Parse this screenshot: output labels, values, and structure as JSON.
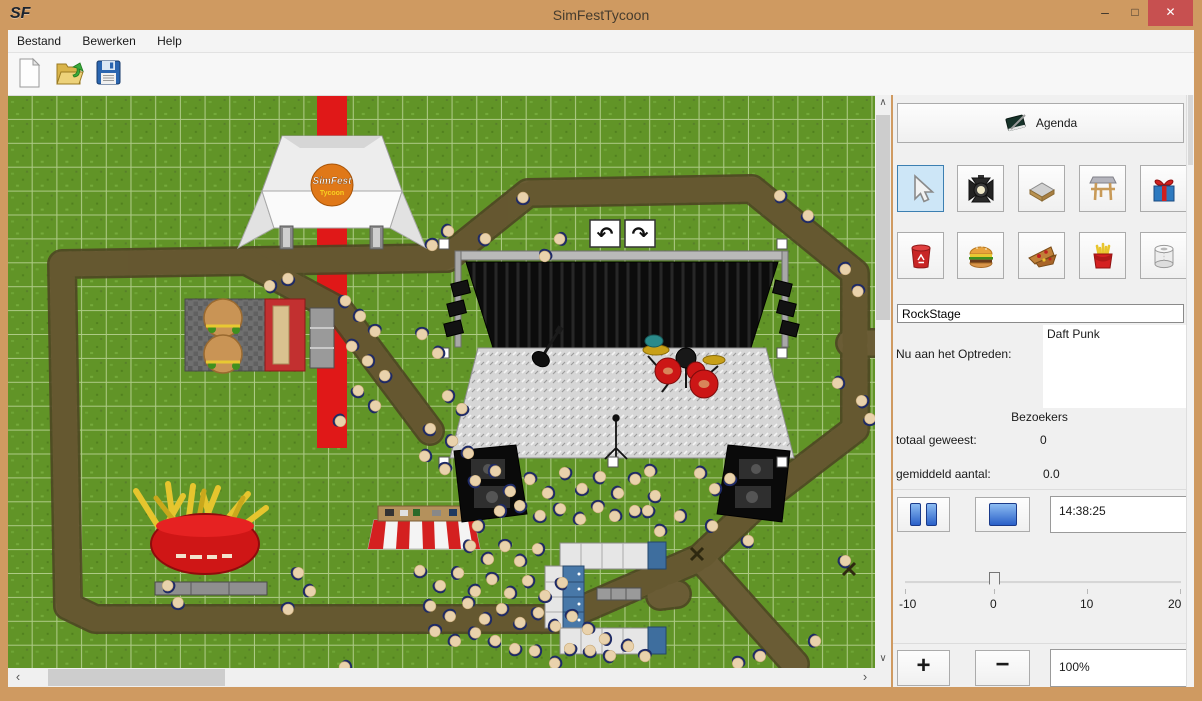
{
  "window": {
    "title": "SimFestTycoon",
    "app_initials": "SF",
    "controls": {
      "minimize": "–",
      "maximize": "□",
      "close": "✕"
    }
  },
  "menu": {
    "items": [
      "Bestand",
      "Bewerken",
      "Help"
    ]
  },
  "toolbar": {
    "buttons": [
      "new-file",
      "open-file",
      "save-file"
    ]
  },
  "icons": {
    "scroll_up": "∧",
    "scroll_down": "∨",
    "scroll_left": "‹",
    "scroll_right": "›",
    "rotate_left": "↶",
    "rotate_right": "↷"
  },
  "colors": {
    "titlebar": "#cf9a61",
    "close_button": "#c75050",
    "selected_tool_bg": "#cde6f7",
    "selected_tool_border": "#3c7fb1",
    "grass": "#619427",
    "path": "#6a5c35",
    "carpet": "#e01818",
    "person_head": "#e9d2ac",
    "person_body": "#1e2a66"
  },
  "panel": {
    "agenda_label": "Agenda",
    "tools": {
      "row1": [
        "cursor",
        "spotlight",
        "path-tile",
        "stage",
        "gift"
      ],
      "row2": [
        "trash-bin",
        "burger",
        "pizza",
        "fries",
        "toilet-paper"
      ],
      "selected": "cursor"
    },
    "stage_name_value": "RockStage",
    "now_performing_label": "Nu aan het Optreden:",
    "performer": "Daft Punk",
    "visitors_header": "Bezoekers",
    "visitors_total_label": "totaal geweest:",
    "visitors_total_value": "0",
    "visitors_avg_label": "gemiddeld aantal:",
    "visitors_avg_value": "0.0",
    "pause_label": "pause",
    "stop_label": "stop",
    "time_value": "14:38:25",
    "slider": {
      "min": -10,
      "max": 20,
      "value": 0,
      "tick_labels": [
        "-10",
        "0",
        "10",
        "20"
      ]
    },
    "zoom_in_label": "+",
    "zoom_out_label": "−",
    "zoom_value": "100%"
  },
  "canvas": {
    "stage_selected": true,
    "tent_logo_title": "SimFest",
    "tent_logo_subtitle": "Tycoon",
    "people": [
      [
        515,
        102
      ],
      [
        477,
        143
      ],
      [
        440,
        135
      ],
      [
        424,
        149
      ],
      [
        537,
        160
      ],
      [
        552,
        143
      ],
      [
        772,
        100
      ],
      [
        800,
        120
      ],
      [
        337,
        205
      ],
      [
        352,
        220
      ],
      [
        367,
        235
      ],
      [
        344,
        250
      ],
      [
        360,
        265
      ],
      [
        377,
        280
      ],
      [
        350,
        295
      ],
      [
        367,
        310
      ],
      [
        332,
        325
      ],
      [
        414,
        238
      ],
      [
        430,
        257
      ],
      [
        440,
        300
      ],
      [
        454,
        313
      ],
      [
        422,
        333
      ],
      [
        444,
        345
      ],
      [
        460,
        357
      ],
      [
        437,
        373
      ],
      [
        417,
        360
      ],
      [
        262,
        190
      ],
      [
        280,
        183
      ],
      [
        467,
        385
      ],
      [
        487,
        375
      ],
      [
        502,
        395
      ],
      [
        522,
        383
      ],
      [
        540,
        397
      ],
      [
        557,
        377
      ],
      [
        574,
        393
      ],
      [
        592,
        381
      ],
      [
        610,
        397
      ],
      [
        627,
        383
      ],
      [
        642,
        375
      ],
      [
        492,
        415
      ],
      [
        512,
        410
      ],
      [
        532,
        420
      ],
      [
        552,
        413
      ],
      [
        572,
        423
      ],
      [
        590,
        411
      ],
      [
        607,
        420
      ],
      [
        470,
        430
      ],
      [
        627,
        415
      ],
      [
        647,
        400
      ],
      [
        462,
        450
      ],
      [
        480,
        463
      ],
      [
        497,
        450
      ],
      [
        512,
        465
      ],
      [
        530,
        453
      ],
      [
        412,
        475
      ],
      [
        432,
        490
      ],
      [
        450,
        477
      ],
      [
        467,
        495
      ],
      [
        484,
        483
      ],
      [
        502,
        497
      ],
      [
        520,
        485
      ],
      [
        537,
        500
      ],
      [
        554,
        487
      ],
      [
        422,
        510
      ],
      [
        442,
        520
      ],
      [
        460,
        507
      ],
      [
        477,
        523
      ],
      [
        494,
        513
      ],
      [
        512,
        527
      ],
      [
        530,
        517
      ],
      [
        547,
        530
      ],
      [
        564,
        520
      ],
      [
        580,
        533
      ],
      [
        597,
        543
      ],
      [
        562,
        553
      ],
      [
        582,
        555
      ],
      [
        602,
        560
      ],
      [
        620,
        550
      ],
      [
        637,
        560
      ],
      [
        547,
        567
      ],
      [
        527,
        555
      ],
      [
        507,
        553
      ],
      [
        487,
        545
      ],
      [
        467,
        537
      ],
      [
        447,
        545
      ],
      [
        427,
        535
      ],
      [
        692,
        377
      ],
      [
        707,
        393
      ],
      [
        722,
        383
      ],
      [
        740,
        445
      ],
      [
        704,
        430
      ],
      [
        837,
        173
      ],
      [
        850,
        195
      ],
      [
        830,
        287
      ],
      [
        854,
        305
      ],
      [
        862,
        323
      ],
      [
        837,
        465
      ],
      [
        807,
        545
      ],
      [
        752,
        560
      ],
      [
        730,
        567
      ],
      [
        337,
        571
      ],
      [
        160,
        490
      ],
      [
        170,
        507
      ],
      [
        290,
        477
      ],
      [
        302,
        495
      ],
      [
        280,
        513
      ],
      [
        652,
        435
      ],
      [
        672,
        420
      ],
      [
        640,
        415
      ]
    ]
  }
}
